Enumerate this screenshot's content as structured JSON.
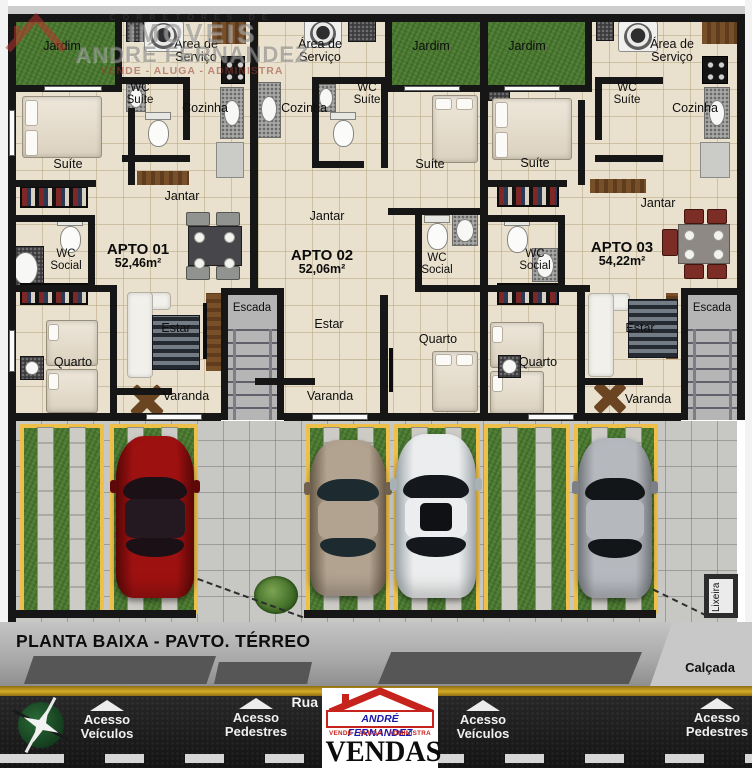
{
  "watermark": {
    "top_line": "CORRETORES DE",
    "brand": "IMOVEIS",
    "name": "ANDRÉ FERNANDEZ",
    "tagline": "VENDE - ALUGA - ADMINISTRA"
  },
  "labels": {
    "jardim": "Jardim",
    "area_servico": "Área de Serviço",
    "cozinha": "Cozinha",
    "wc_suite": "WC Suíte",
    "suite": "Suíte",
    "jantar": "Jantar",
    "wc_social": "WC Social",
    "estar": "Estar",
    "quarto": "Quarto",
    "varanda": "Varanda",
    "escada": "Escada",
    "lixeira": "Lixeira"
  },
  "apartments": [
    {
      "name": "APTO 01",
      "area": "52,46m²"
    },
    {
      "name": "APTO 02",
      "area": "52,06m²"
    },
    {
      "name": "APTO 03",
      "area": "54,22m²"
    }
  ],
  "street": {
    "plan_title": "PLANTA BAIXA - PAVTO. TÉRREO",
    "calcada": "Calçada",
    "rua": "Rua",
    "acesso_veiculos": "Acesso Veículos",
    "acesso_pedestres": "Acesso Pedestres"
  },
  "logo": {
    "name": "ANDRÉ FERNANDEZ",
    "tagline": "VENDE - ALUGA - ADMINISTRA",
    "vendas": "VENDAS"
  },
  "colors": {
    "wall": "#161616",
    "floor": "#e9e1cd",
    "grass": "#4c7a31",
    "stall_border": "#eec04a",
    "asphalt": "#1d1d1d",
    "road_stripe": "#c9a227",
    "car_red": "#9e1111",
    "car_tan": "#b2a290",
    "car_white": "#ebedee",
    "car_silver": "#b5b9be",
    "logo_blue": "#1a17ad",
    "logo_red": "#c5231c"
  }
}
